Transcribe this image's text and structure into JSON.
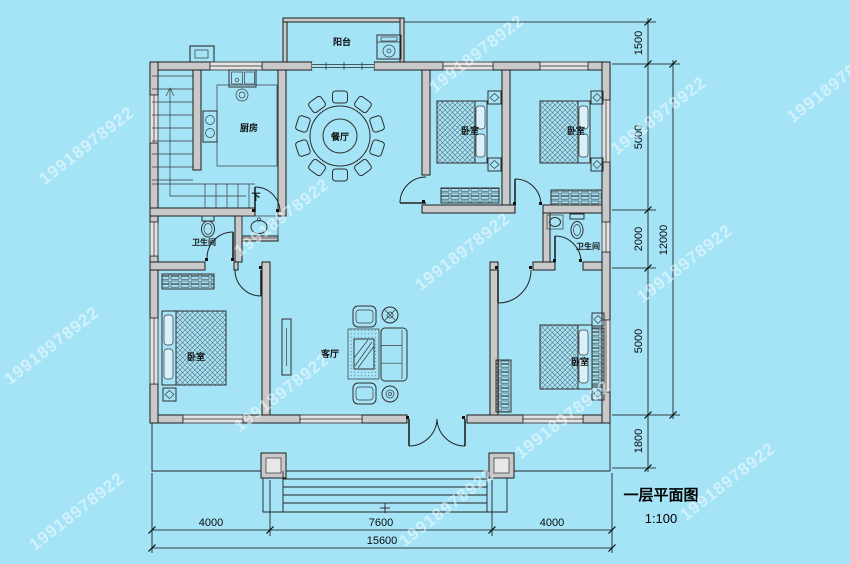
{
  "watermark": {
    "text": "19918978922"
  },
  "title": {
    "text": "一层平面图",
    "scale": "1:100"
  },
  "rooms": {
    "balcony": "阳台",
    "kitchen": "厨房",
    "dining": "餐厅",
    "bedroom": "卧室",
    "bathroom": "卫生间",
    "living": "客厅",
    "stairs_down": "下"
  },
  "dimensions": {
    "right": [
      "1500",
      "5000",
      "2000",
      "5000",
      "1800"
    ],
    "right_total": "12000",
    "bottom": [
      "4000",
      "7600",
      "4000"
    ],
    "bottom_total": "15600"
  },
  "colors": {
    "background": "#a5e4f7",
    "wall_fill": "#c9c9c9",
    "line": "#1b1b1b",
    "watermark": "#ffffff"
  }
}
